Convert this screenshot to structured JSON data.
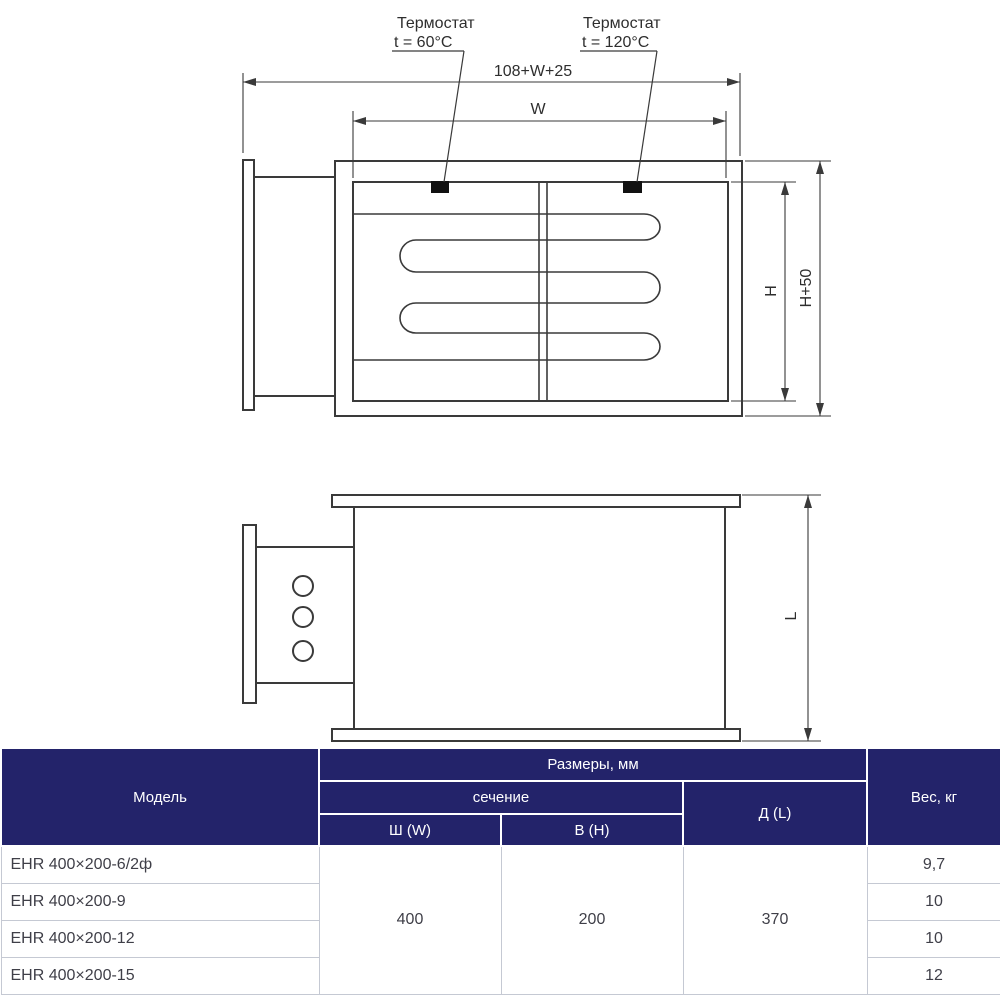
{
  "drawing": {
    "line_color": "#3a3a3a",
    "thermostat_marker_color": "#111111",
    "front_view": {
      "thermostat_left": {
        "line1": "Термостат",
        "line2": "t = 60°C"
      },
      "thermostat_right": {
        "line1": "Термостат",
        "line2": "t = 120°C"
      },
      "dim_total_width": "108+W+25",
      "dim_inner_width": "W",
      "dim_inner_height": "H",
      "dim_outer_height": "H+50"
    },
    "side_view": {
      "dim_length": "L"
    }
  },
  "table": {
    "colors": {
      "header_bg": "#23236a",
      "header_text": "#ffffff",
      "body_text": "#3f3f48",
      "row_border": "#c5c9d3"
    },
    "header": {
      "model": "Модель",
      "dimensions": "Размеры, мм",
      "section": "сечение",
      "width": "Ш (W)",
      "height": "В (H)",
      "length": "Д (L)",
      "weight": "Вес, кг"
    },
    "shared": {
      "width": "400",
      "height": "200",
      "length": "370"
    },
    "rows": [
      {
        "model": "EHR 400×200-6/2ф",
        "weight": "9,7"
      },
      {
        "model": "EHR 400×200-9",
        "weight": "10"
      },
      {
        "model": "EHR 400×200-12",
        "weight": "10"
      },
      {
        "model": "EHR 400×200-15",
        "weight": "12"
      }
    ]
  }
}
